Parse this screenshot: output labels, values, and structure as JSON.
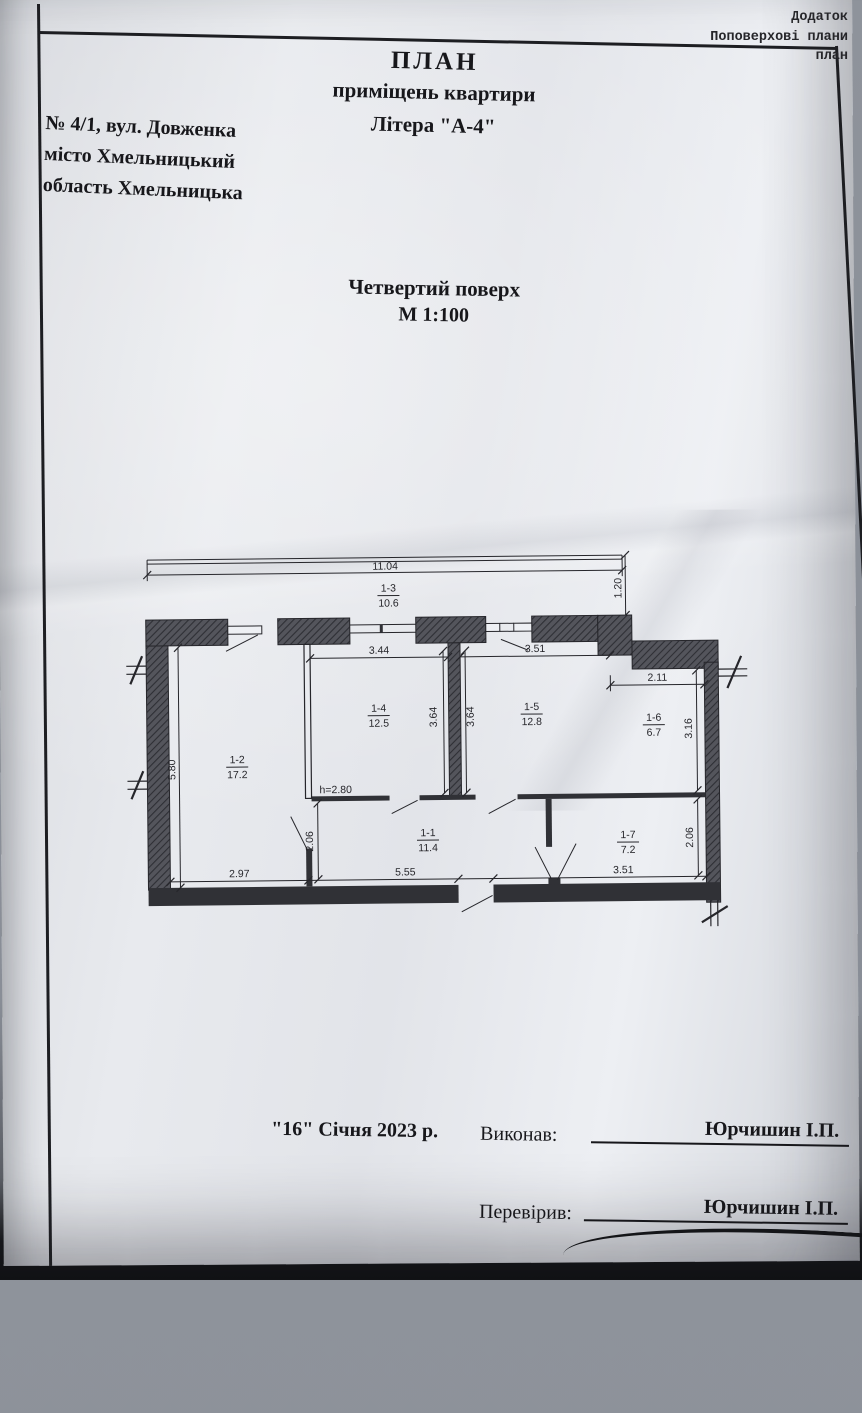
{
  "corner_note": {
    "line1": "Додаток",
    "line2": "Поповерхові плани",
    "line3": "план"
  },
  "header": {
    "title": "ПЛАН",
    "subtitle": "приміщень квартири",
    "litera": "Літера \"А-4\""
  },
  "address": {
    "line1": "№ 4/1, вул. Довженка",
    "line2": "місто Хмельницький",
    "line3": "область Хмельницька"
  },
  "floor_title": {
    "line1": "Четвертий поверх",
    "line2": "М 1:100"
  },
  "plan": {
    "rooms": [
      {
        "id": "1-1",
        "area": "11.4"
      },
      {
        "id": "1-2",
        "area": "17.2"
      },
      {
        "id": "1-3",
        "area": "10.6"
      },
      {
        "id": "1-4",
        "area": "12.5"
      },
      {
        "id": "1-5",
        "area": "12.8"
      },
      {
        "id": "1-6",
        "area": "6.7"
      },
      {
        "id": "1-7",
        "area": "7.2"
      }
    ],
    "dims": {
      "overall_width": "11.04",
      "balcony_depth": "1.20",
      "room4_width": "3.44",
      "room5_width": "3.51",
      "room6_width": "2.11",
      "room4_depth": "3.64",
      "room5_depth": "3.64",
      "room6_depth": "3.16",
      "left_height": "5.80",
      "ceiling_height": "h=2.80",
      "hall_door_depth": "2.06",
      "room7_depth": "2.06",
      "bottom_left": "2.97",
      "bottom_middle": "5.55",
      "bottom_right": "3.51"
    }
  },
  "footer": {
    "date": "\"16\" Січня 2023 р.",
    "executed_label": "Виконав:",
    "executed_name": "Юрчишин І.П.",
    "checked_label": "Перевірив:",
    "checked_name": "Юрчишин І.П."
  }
}
